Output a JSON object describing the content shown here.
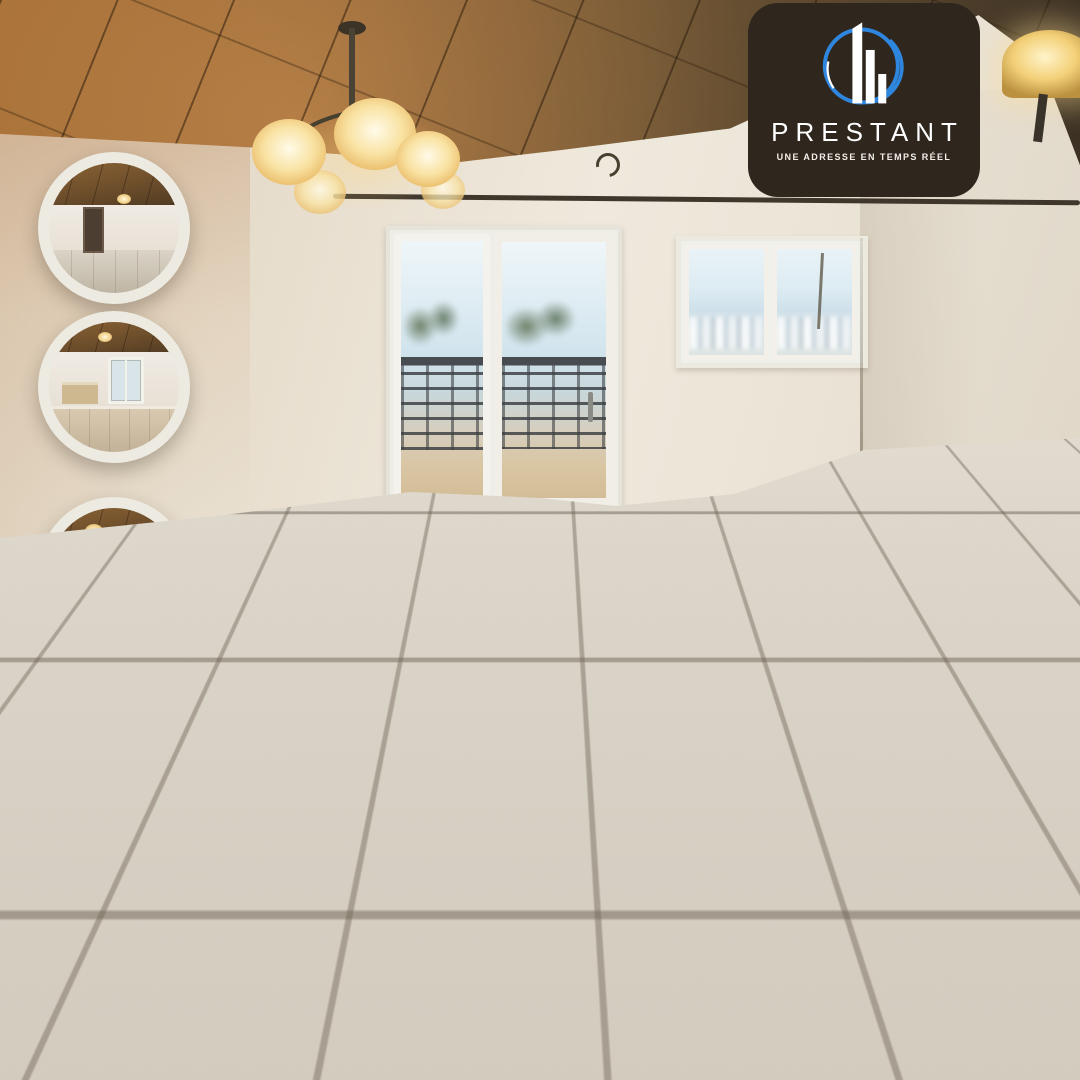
{
  "brand": {
    "name": "PRESTANT",
    "tagline": "UNE ADRESSE EN TEMPS RÉEL",
    "logo_icon": "buildings-in-blue-circle",
    "panel_color": "#2f261e",
    "ring_color": "#2e86de"
  },
  "listing": {
    "city": "Yaoundé",
    "title_line1": "APPARTEMENT",
    "title_line2": "HAUT STANDING",
    "status_badge": "À Louer",
    "area": {
      "value": "135",
      "unit_base": "M",
      "unit_sup": "2",
      "qualifier": "(Environ)"
    },
    "intro": "Votre futur propriété",
    "location": "ODZA",
    "features": [
      "Avec Lustre",
      "Eau Chaude",
      "Parking + Gardien"
    ]
  },
  "contact": {
    "phone_prefix": "(+237)",
    "phone_number": "653323187",
    "facebook": "@prestant237",
    "email": "prestant237@gmail.com"
  },
  "icons": {
    "location": "map-pin",
    "phone": "phone-receiver",
    "facebook_glyph": "f",
    "email": "envelope"
  },
  "colors": {
    "accent_blue": "#2196f3",
    "badge_gradient_start": "#6fd3ea",
    "badge_gradient_end": "#1565c5",
    "paper": "#f2ecdf",
    "area_circle": "#dcdfd7",
    "ceiling_brown": "#6f5534",
    "text": "#171715"
  }
}
